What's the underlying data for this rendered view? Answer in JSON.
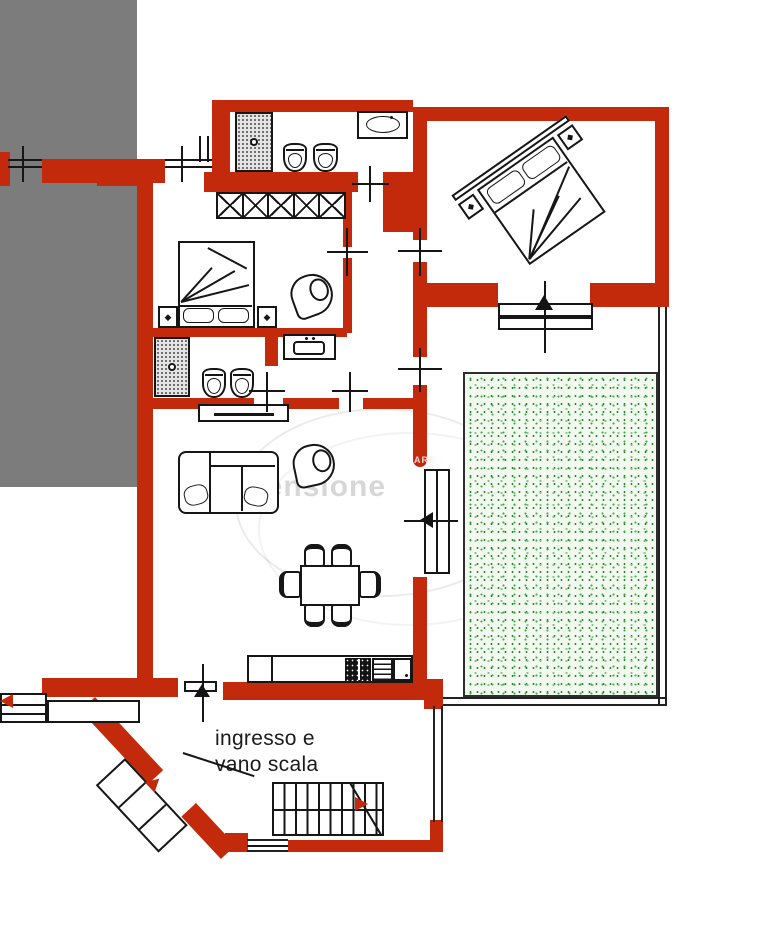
{
  "title": "apartment floor plan",
  "labels": {
    "entrance_line1": "ingresso e",
    "entrance_line2": "vano scala"
  },
  "watermark": {
    "text": "censione",
    "wall_text": "ARE"
  },
  "glyphs": {
    "nightstand_marker": "◆"
  },
  "colors": {
    "wall_red": "#c22a0b",
    "line_black": "#161616",
    "adjacent_gray": "#7c7c7c",
    "garden_bg": "#f2faef",
    "garden_dot": "#3da84c",
    "garden_dot2": "#7cc87f"
  }
}
